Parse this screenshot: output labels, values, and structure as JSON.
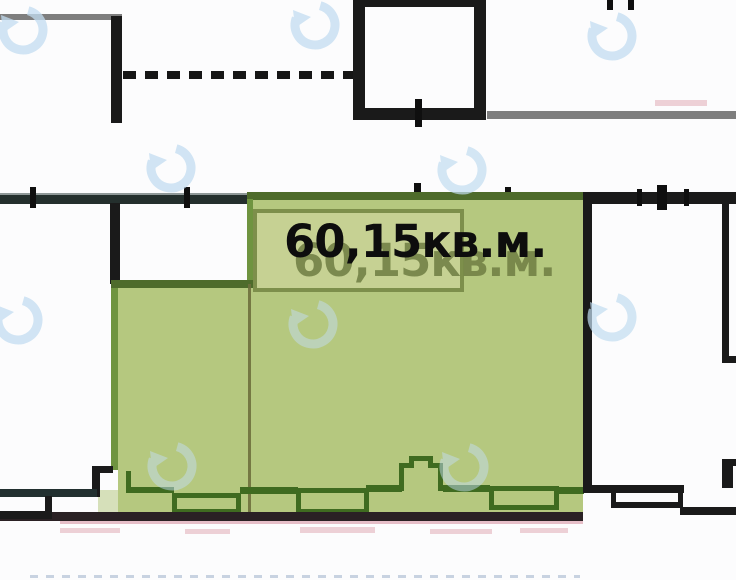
{
  "plan": {
    "area_label": "60,15кв.м.",
    "area_label_ghost": "60,15кв.м."
  },
  "colors": {
    "green_fill": "#b5c87f",
    "green_fill_light": "#c6d193",
    "green_border_dark": "#4e6b2b",
    "green_edge": "#6f9440",
    "box_border": "#7d8f4b",
    "window_outline": "#3f6b20",
    "divider": "#6e6f3d",
    "wall_black": "#1a1a1a",
    "wall_teal": "#223030",
    "wall_gray": "#7e7e7e",
    "bottom_line": "#2a2124",
    "pink_tint": "#cd7387",
    "watermark_blue": "#c3ddf1",
    "label_text": "#0d0d0d",
    "ghost_text": "#6f7d42"
  },
  "watermarks": [
    {
      "x": 23,
      "y": 30,
      "opacity": 0.75
    },
    {
      "x": 315,
      "y": 25,
      "opacity": 0.75
    },
    {
      "x": 612,
      "y": 36,
      "opacity": 0.75
    },
    {
      "x": 171,
      "y": 168,
      "opacity": 0.75
    },
    {
      "x": 462,
      "y": 170,
      "opacity": 0.7
    },
    {
      "x": 18,
      "y": 320,
      "opacity": 0.75
    },
    {
      "x": 313,
      "y": 324,
      "opacity": 0.5
    },
    {
      "x": 612,
      "y": 317,
      "opacity": 0.7
    },
    {
      "x": 172,
      "y": 466,
      "opacity": 0.5
    },
    {
      "x": 464,
      "y": 467,
      "opacity": 0.5
    }
  ],
  "watermark_size": 56
}
